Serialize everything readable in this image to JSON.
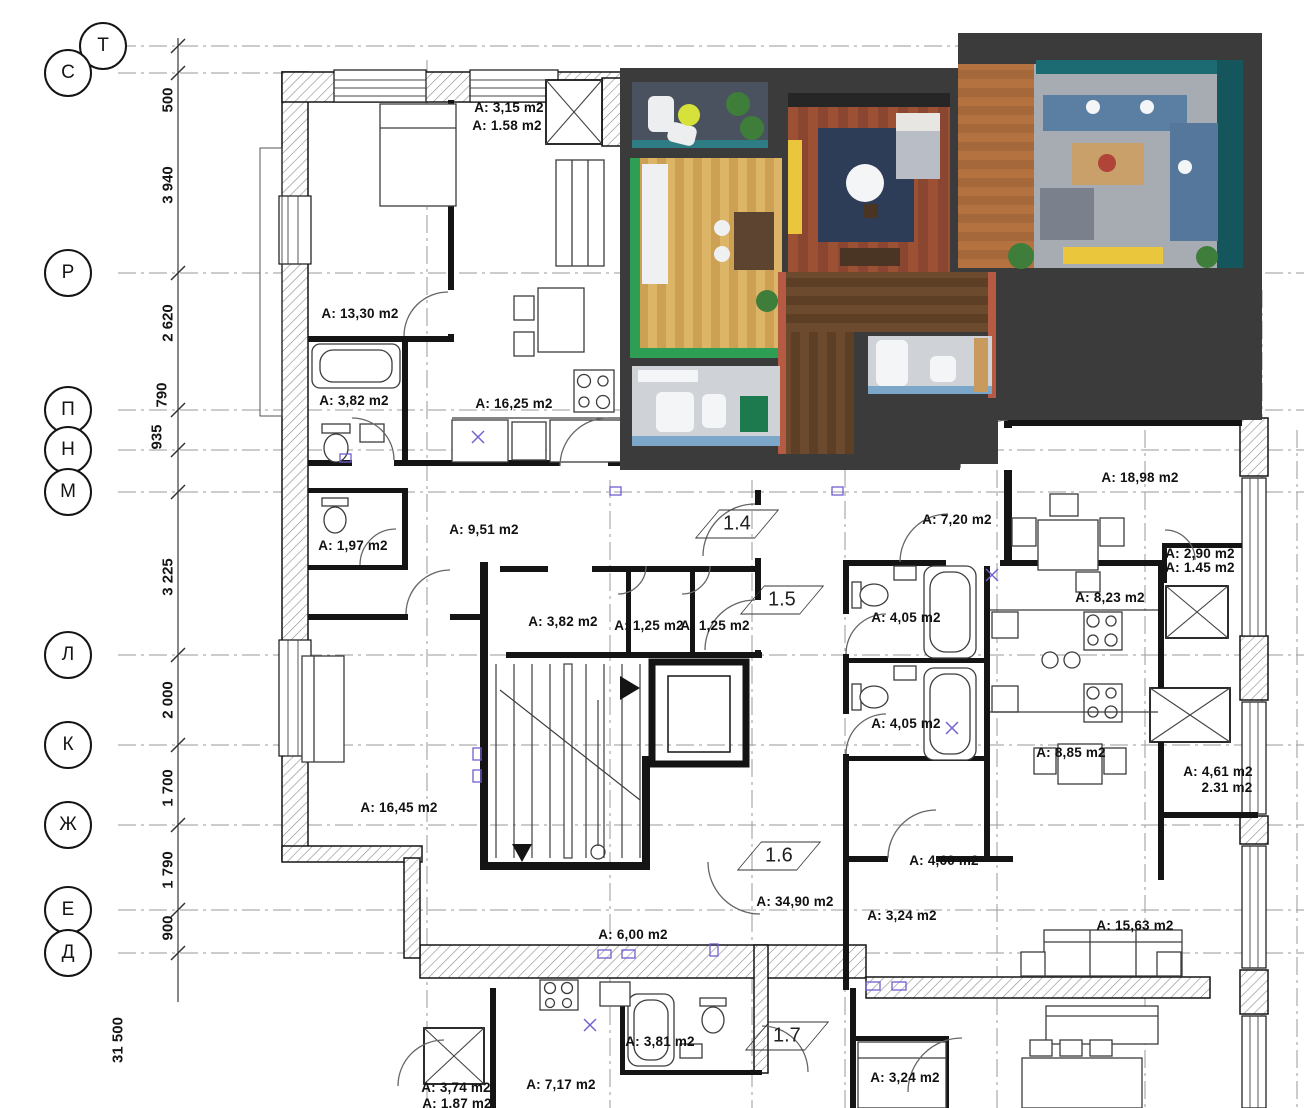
{
  "plan": {
    "drawing_type": "architectural floor plan with 3D furnished render",
    "axes": [
      {
        "label": "Т",
        "x": 103,
        "y": 46
      },
      {
        "label": "С",
        "x": 68,
        "y": 73
      },
      {
        "label": "Р",
        "x": 68,
        "y": 273
      },
      {
        "label": "П",
        "x": 68,
        "y": 410
      },
      {
        "label": "Н",
        "x": 68,
        "y": 450
      },
      {
        "label": "М",
        "x": 68,
        "y": 492
      },
      {
        "label": "Л",
        "x": 68,
        "y": 655
      },
      {
        "label": "К",
        "x": 68,
        "y": 745
      },
      {
        "label": "Ж",
        "x": 68,
        "y": 825
      },
      {
        "label": "Е",
        "x": 68,
        "y": 910
      },
      {
        "label": "Д",
        "x": 68,
        "y": 953
      }
    ],
    "dimension_line": {
      "segments": [
        {
          "text": "500",
          "x": 168,
          "y": 100
        },
        {
          "text": "3 940",
          "x": 168,
          "y": 185
        },
        {
          "text": "2 620",
          "x": 168,
          "y": 323
        },
        {
          "text": "790",
          "x": 162,
          "y": 395
        },
        {
          "text": "935",
          "x": 157,
          "y": 437
        },
        {
          "text": "3 225",
          "x": 168,
          "y": 577
        },
        {
          "text": "2 000",
          "x": 168,
          "y": 700
        },
        {
          "text": "1 700",
          "x": 168,
          "y": 788
        },
        {
          "text": "1 790",
          "x": 168,
          "y": 870
        },
        {
          "text": "900",
          "x": 168,
          "y": 928
        }
      ],
      "overall": {
        "text": "31 500",
        "x": 118,
        "y": 1040
      }
    },
    "room_labels": [
      {
        "text": "A: 3,15 m2",
        "x": 509,
        "y": 108
      },
      {
        "text": "A: 1.58 m2",
        "x": 507,
        "y": 126
      },
      {
        "text": "A: 13,30 m2",
        "x": 360,
        "y": 314
      },
      {
        "text": "A: 3,82 m2",
        "x": 354,
        "y": 401
      },
      {
        "text": "A: 16,25 m2",
        "x": 514,
        "y": 404
      },
      {
        "text": "A: 1,97 m2",
        "x": 353,
        "y": 546
      },
      {
        "text": "A: 9,51 m2",
        "x": 484,
        "y": 530
      },
      {
        "text": "A: 3,82 m2",
        "x": 563,
        "y": 622
      },
      {
        "text": "A: 1,25 m2",
        "x": 649,
        "y": 626
      },
      {
        "text": "A: 1,25 m2",
        "x": 715,
        "y": 626
      },
      {
        "text": "A: 7,20 m2",
        "x": 957,
        "y": 520
      },
      {
        "text": "A: 18,98 m2",
        "x": 1140,
        "y": 478
      },
      {
        "text": "A: 2,90 m2",
        "x": 1200,
        "y": 554
      },
      {
        "text": "A: 1.45 m2",
        "x": 1200,
        "y": 568
      },
      {
        "text": "A: 8,23 m2",
        "x": 1110,
        "y": 598
      },
      {
        "text": "A: 4,05 m2",
        "x": 906,
        "y": 618
      },
      {
        "text": "A: 4,05 m2",
        "x": 906,
        "y": 724
      },
      {
        "text": "A: 8,85 m2",
        "x": 1071,
        "y": 753
      },
      {
        "text": "A: 4,61 m2",
        "x": 1218,
        "y": 772
      },
      {
        "text": "2.31 m2",
        "x": 1227,
        "y": 788
      },
      {
        "text": "A: 16,45 m2",
        "x": 399,
        "y": 808
      },
      {
        "text": "A: 4,60 m2",
        "x": 944,
        "y": 861
      },
      {
        "text": "A: 34,90 m2",
        "x": 795,
        "y": 902
      },
      {
        "text": "A: 3,24 m2",
        "x": 902,
        "y": 916
      },
      {
        "text": "A: 15,63 m2",
        "x": 1135,
        "y": 926
      },
      {
        "text": "A: 6,00 m2",
        "x": 633,
        "y": 935
      },
      {
        "text": "A: 3,81 m2",
        "x": 660,
        "y": 1042
      },
      {
        "text": "A: 3,24 m2",
        "x": 905,
        "y": 1078
      },
      {
        "text": "A: 7,17 m2",
        "x": 561,
        "y": 1085
      },
      {
        "text": "A: 3,74 m2",
        "x": 456,
        "y": 1088
      },
      {
        "text": "A: 1.87 m2",
        "x": 457,
        "y": 1104
      }
    ],
    "unit_flags": [
      {
        "text": "1.4",
        "x": 737,
        "y": 524
      },
      {
        "text": "1.5",
        "x": 782,
        "y": 600
      },
      {
        "text": "1.6",
        "x": 779,
        "y": 856
      },
      {
        "text": "1.7",
        "x": 787,
        "y": 1036
      }
    ],
    "colors": {
      "wall_line": "#141414",
      "hatch_line": "#8a8a8a",
      "grid_line": "#9a9a9a",
      "fixture_line": "#3c3c3c",
      "door_arc": "#666666",
      "symbol_violet": "#6f5fd0"
    },
    "render": {
      "wall": "#3b3b3b",
      "dark_band": "#262626",
      "balcony_floor": "#49525e",
      "glass": "#2e7d85",
      "plant": "#3f7d3a",
      "lounger": "#eceeef",
      "balcony_table": "#d6e23a",
      "kitchen_floor_a": "#ddb567",
      "kitchen_floor_b": "#cda153",
      "green_wall": "#2f9e55",
      "cabinet": "#eef0f2",
      "dining_table": "#5d4430",
      "bedroom_floor_a": "#9c5134",
      "bedroom_floor_b": "#8a4630",
      "rug_navy": "#2e3d57",
      "sofa_yellow": "#e9c63b",
      "bed_white": "#e8e6e2",
      "blanket": "#b9bec6",
      "desk": "#4a3424",
      "living_wood_a": "#b3723f",
      "living_wood_b": "#a5683a",
      "living_gray": "#a7abb2",
      "teal_wall": "#1d6b72",
      "teal_dark": "#15565c",
      "sofa_blue": "#5b7fa3",
      "sofa_blue2": "#54779b",
      "rug_tan": "#c9a06a",
      "rug_red": "#b04438",
      "armchair": "#7a818c",
      "tv_bench": "#e9c63b",
      "hall_floor_a": "#6b4a2e",
      "hall_floor_b": "#5d3f26",
      "wardrobe_red": "#b55a43",
      "bath_floor": "#cfd3d7",
      "bath_blue": "#7ca7c8",
      "fixture": "#f4f5f6",
      "green_box": "#1d7a4f",
      "wood_shelf": "#c99a5e"
    }
  }
}
